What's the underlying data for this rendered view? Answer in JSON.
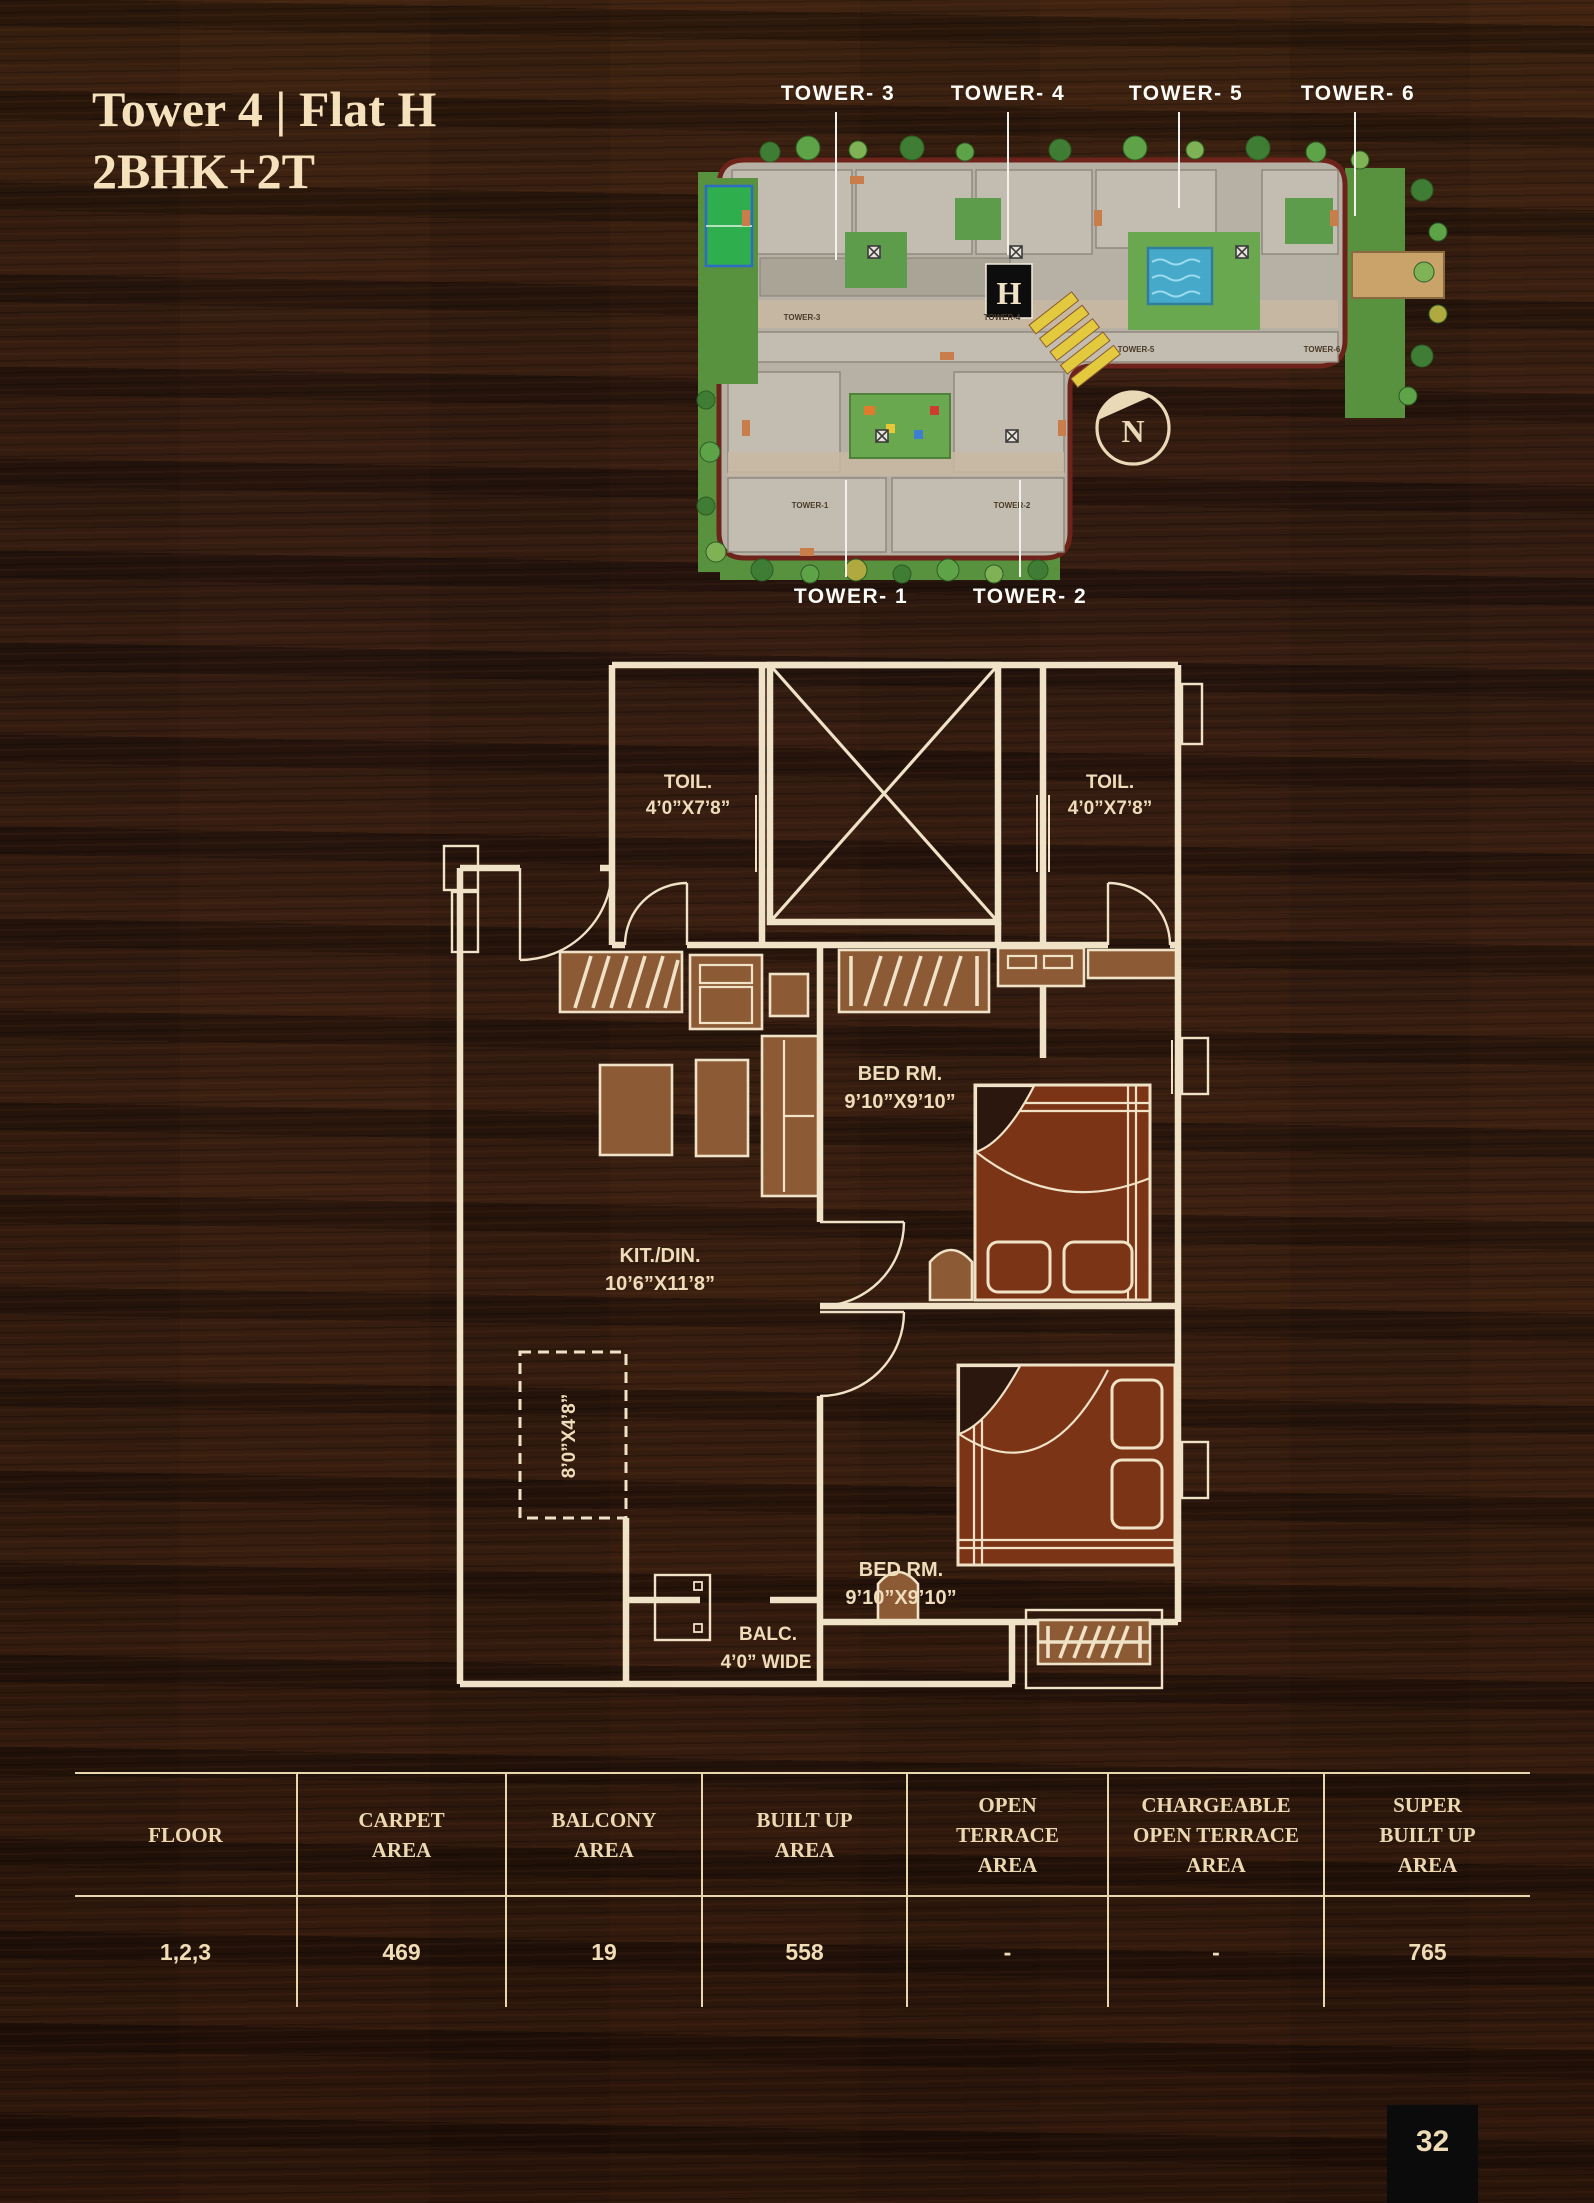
{
  "page": {
    "title_line1": "Tower 4 | Flat H",
    "title_line2": "2BHK+2T",
    "page_number": "32"
  },
  "site_plan": {
    "towers_top": [
      "TOWER- 3",
      "TOWER- 4",
      "TOWER- 5",
      "TOWER- 6"
    ],
    "towers_bottom": [
      "TOWER- 1",
      "TOWER- 2"
    ],
    "building_labels": [
      "TOWER-3",
      "TOWER-4",
      "TOWER-5",
      "TOWER-6",
      "TOWER-1",
      "TOWER-2"
    ],
    "flat_marker": "H",
    "compass_label": "N"
  },
  "floor_plan": {
    "rooms": [
      {
        "name": "TOIL.",
        "dims": "4’0”X7’8”"
      },
      {
        "name": "TOIL.",
        "dims": "4’0”X7’8”"
      },
      {
        "name": "BED RM.",
        "dims": "9’10”X9’10”"
      },
      {
        "name": "KIT./DIN.",
        "dims": "10’6”X11’8”"
      },
      {
        "name": "BED RM.",
        "dims": "9’10”X9’10”"
      },
      {
        "name": "BALC.",
        "dims": "4’0” WIDE"
      },
      {
        "name": "",
        "dims": "8’0”X4’8”"
      }
    ]
  },
  "table": {
    "headers": [
      "FLOOR",
      "CARPET\nAREA",
      "BALCONY\nAREA",
      "BUILT UP\nAREA",
      "OPEN\nTERRACE\nAREA",
      "CHARGEABLE\nOPEN TERRACE\nAREA",
      "SUPER\nBUILT UP\nAREA"
    ],
    "row": [
      "1,2,3",
      "469",
      "19",
      "558",
      "-",
      "-",
      "765"
    ]
  },
  "colors": {
    "cream": "#eedcba",
    "plan_line": "#efe2c6",
    "wood": "#2b170d",
    "furniture": "#8d5a36",
    "bed": "#7c3416"
  }
}
